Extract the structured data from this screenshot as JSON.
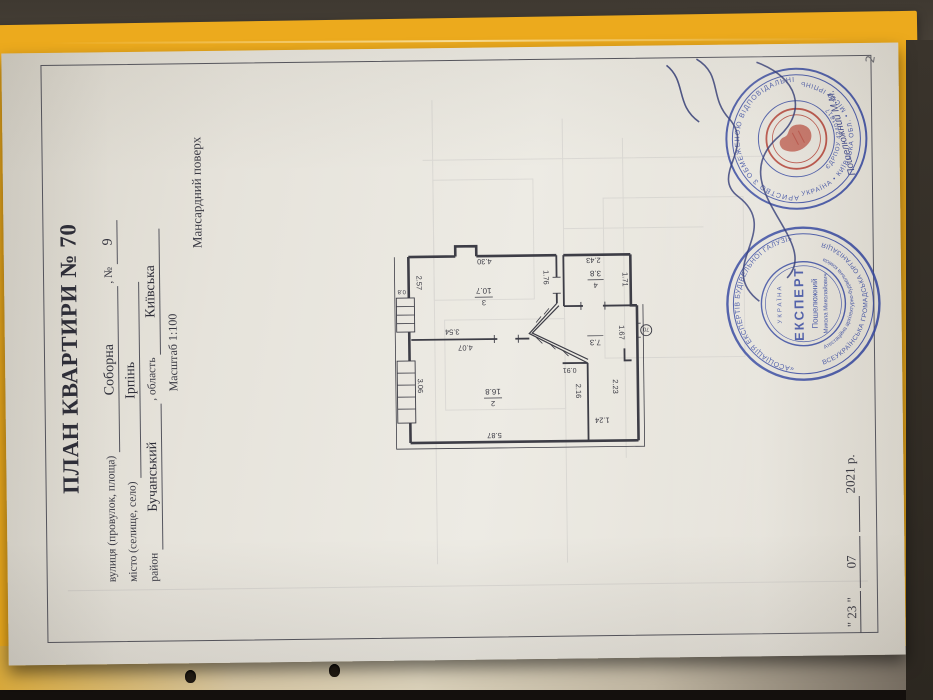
{
  "document": {
    "title": "ПЛАН КВАРТИРИ № 70",
    "page_number": "2",
    "address": {
      "street_label": "вулиця (провулок, площа)",
      "street_value": "Соборна",
      "number_label": ", №",
      "number_value": "9",
      "city_label": "місто (селище, село)",
      "city_value": "Ірпінь",
      "district_label": "район",
      "district_value": "Бучанський",
      "region_label": ", область",
      "region_value": "Київська",
      "scale": "Масштаб 1:100"
    },
    "floor_caption": "Мансардний поверх",
    "date": {
      "day": "\" 23 \"",
      "month": "07",
      "year": "2021 р."
    }
  },
  "plan": {
    "rooms": [
      {
        "number": "3",
        "area": "10.7"
      },
      {
        "number": "4",
        "area": "3.8"
      },
      {
        "number": "",
        "area": "7.3"
      },
      {
        "number": "2",
        "area": "16.8"
      }
    ],
    "dims": {
      "room3_len": "4.30",
      "room3_wid": "2.57",
      "hall_wall": "1.76",
      "room4_len": "2.43",
      "room4_wid": "1.71",
      "wall_354": "3.54",
      "wall_407": "4.07",
      "room2_wid": "3.06",
      "room2_len": "5.87",
      "window": "0.8",
      "stair": "0.91",
      "hall_216": "2.16",
      "hall_223": "2.23",
      "hall_124": "1.24",
      "hall_167": "1.67"
    },
    "apartment_circle": "70"
  },
  "stamps": {
    "bti": {
      "ring_top": "ТОВАРИСТВО З ОБМЕЖЕНОЮ ВІДПОВІДАЛЬНІСТЮ",
      "ring_bottom": "УКРАЇНА • КИЇВСЬКА ОБЛ. • МІСТО ІРПІНЬ",
      "inner": "ЄДРПОУ 42401817",
      "signed": "Пошелюжний М.М."
    },
    "expert": {
      "ring_top": "«АСОЦІАЦІЯ ЕКСПЕРТІВ БУДІВЕЛЬНОЇ ГАЛУЗІ»",
      "ring_bottom": "ВСЕУКРАЇНСЬКА ГРОМАДСЬКА ОРГАНІЗАЦІЯ",
      "ring_inner": "Атестаційна архітектурно-будівельна комісія",
      "country": "УКРАЇНА",
      "center": "ЕКСПЕРТ",
      "name": "Пошелюжний",
      "name2": "Микола Миколайович"
    }
  },
  "colors": {
    "stamp_blue": "#31449e",
    "emblem_red": "#b03a2e",
    "folder_yellow": "#ecaa1d",
    "paper": "#eae7e0"
  }
}
